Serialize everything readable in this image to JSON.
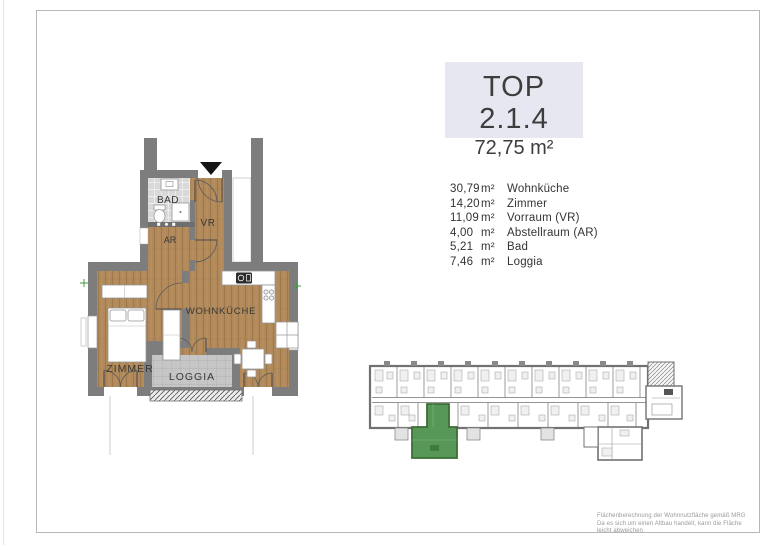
{
  "page": {
    "title": "TOP 2.1.4",
    "total_area": "72,75 m²"
  },
  "rooms": [
    {
      "area": "30,79",
      "unit": "m²",
      "name": "Wohnküche"
    },
    {
      "area": "14,20",
      "unit": "m²",
      "name": "Zimmer"
    },
    {
      "area": "11,09",
      "unit": "m²",
      "name": "Vorraum (VR)"
    },
    {
      "area": "4,00",
      "unit": "m²",
      "name": "Abstellraum (AR)"
    },
    {
      "area": "5,21",
      "unit": "m²",
      "name": "Bad"
    },
    {
      "area": "7,46",
      "unit": "m²",
      "name": "Loggia"
    }
  ],
  "plan": {
    "labels": {
      "bad": "BAD",
      "vr": "VR",
      "ar": "AR",
      "zimmer": "ZIMMER",
      "wohnkueche": "WOHNKÜCHE",
      "loggia": "LOGGIA"
    },
    "icons": {
      "entrance_marker": "filled-triangle-down",
      "survey_marker": "green-cross"
    }
  },
  "overview": {
    "left_edge": 372,
    "right_edge": 646,
    "top_dividers": [
      397,
      424,
      451,
      478,
      505,
      532,
      559,
      586,
      613,
      640
    ],
    "bottom_dividers": [
      398,
      418,
      458,
      488,
      518,
      548,
      578,
      608,
      636
    ],
    "chimneys": [
      384,
      411,
      438,
      465,
      492,
      519,
      546,
      573,
      600,
      627
    ],
    "balconies": [
      395,
      467,
      541
    ],
    "highlighted_unit": "TOP 2.1.4"
  },
  "footer": {
    "line1": "Flächenberechnung der Wohnnutzfläche gemäß MRG",
    "line2": "Da es sich um einen Altbau handelt, kann die Fläche leicht abweichen"
  },
  "colors": {
    "wall": "#7d7d7d",
    "wood": "#b1895a",
    "tile": "#d9d9d9",
    "loggia-tile": "#c6c6c6",
    "highlight-green": "#579757",
    "title-bg": "#e7e7f2",
    "text": "#3a3a3a"
  }
}
